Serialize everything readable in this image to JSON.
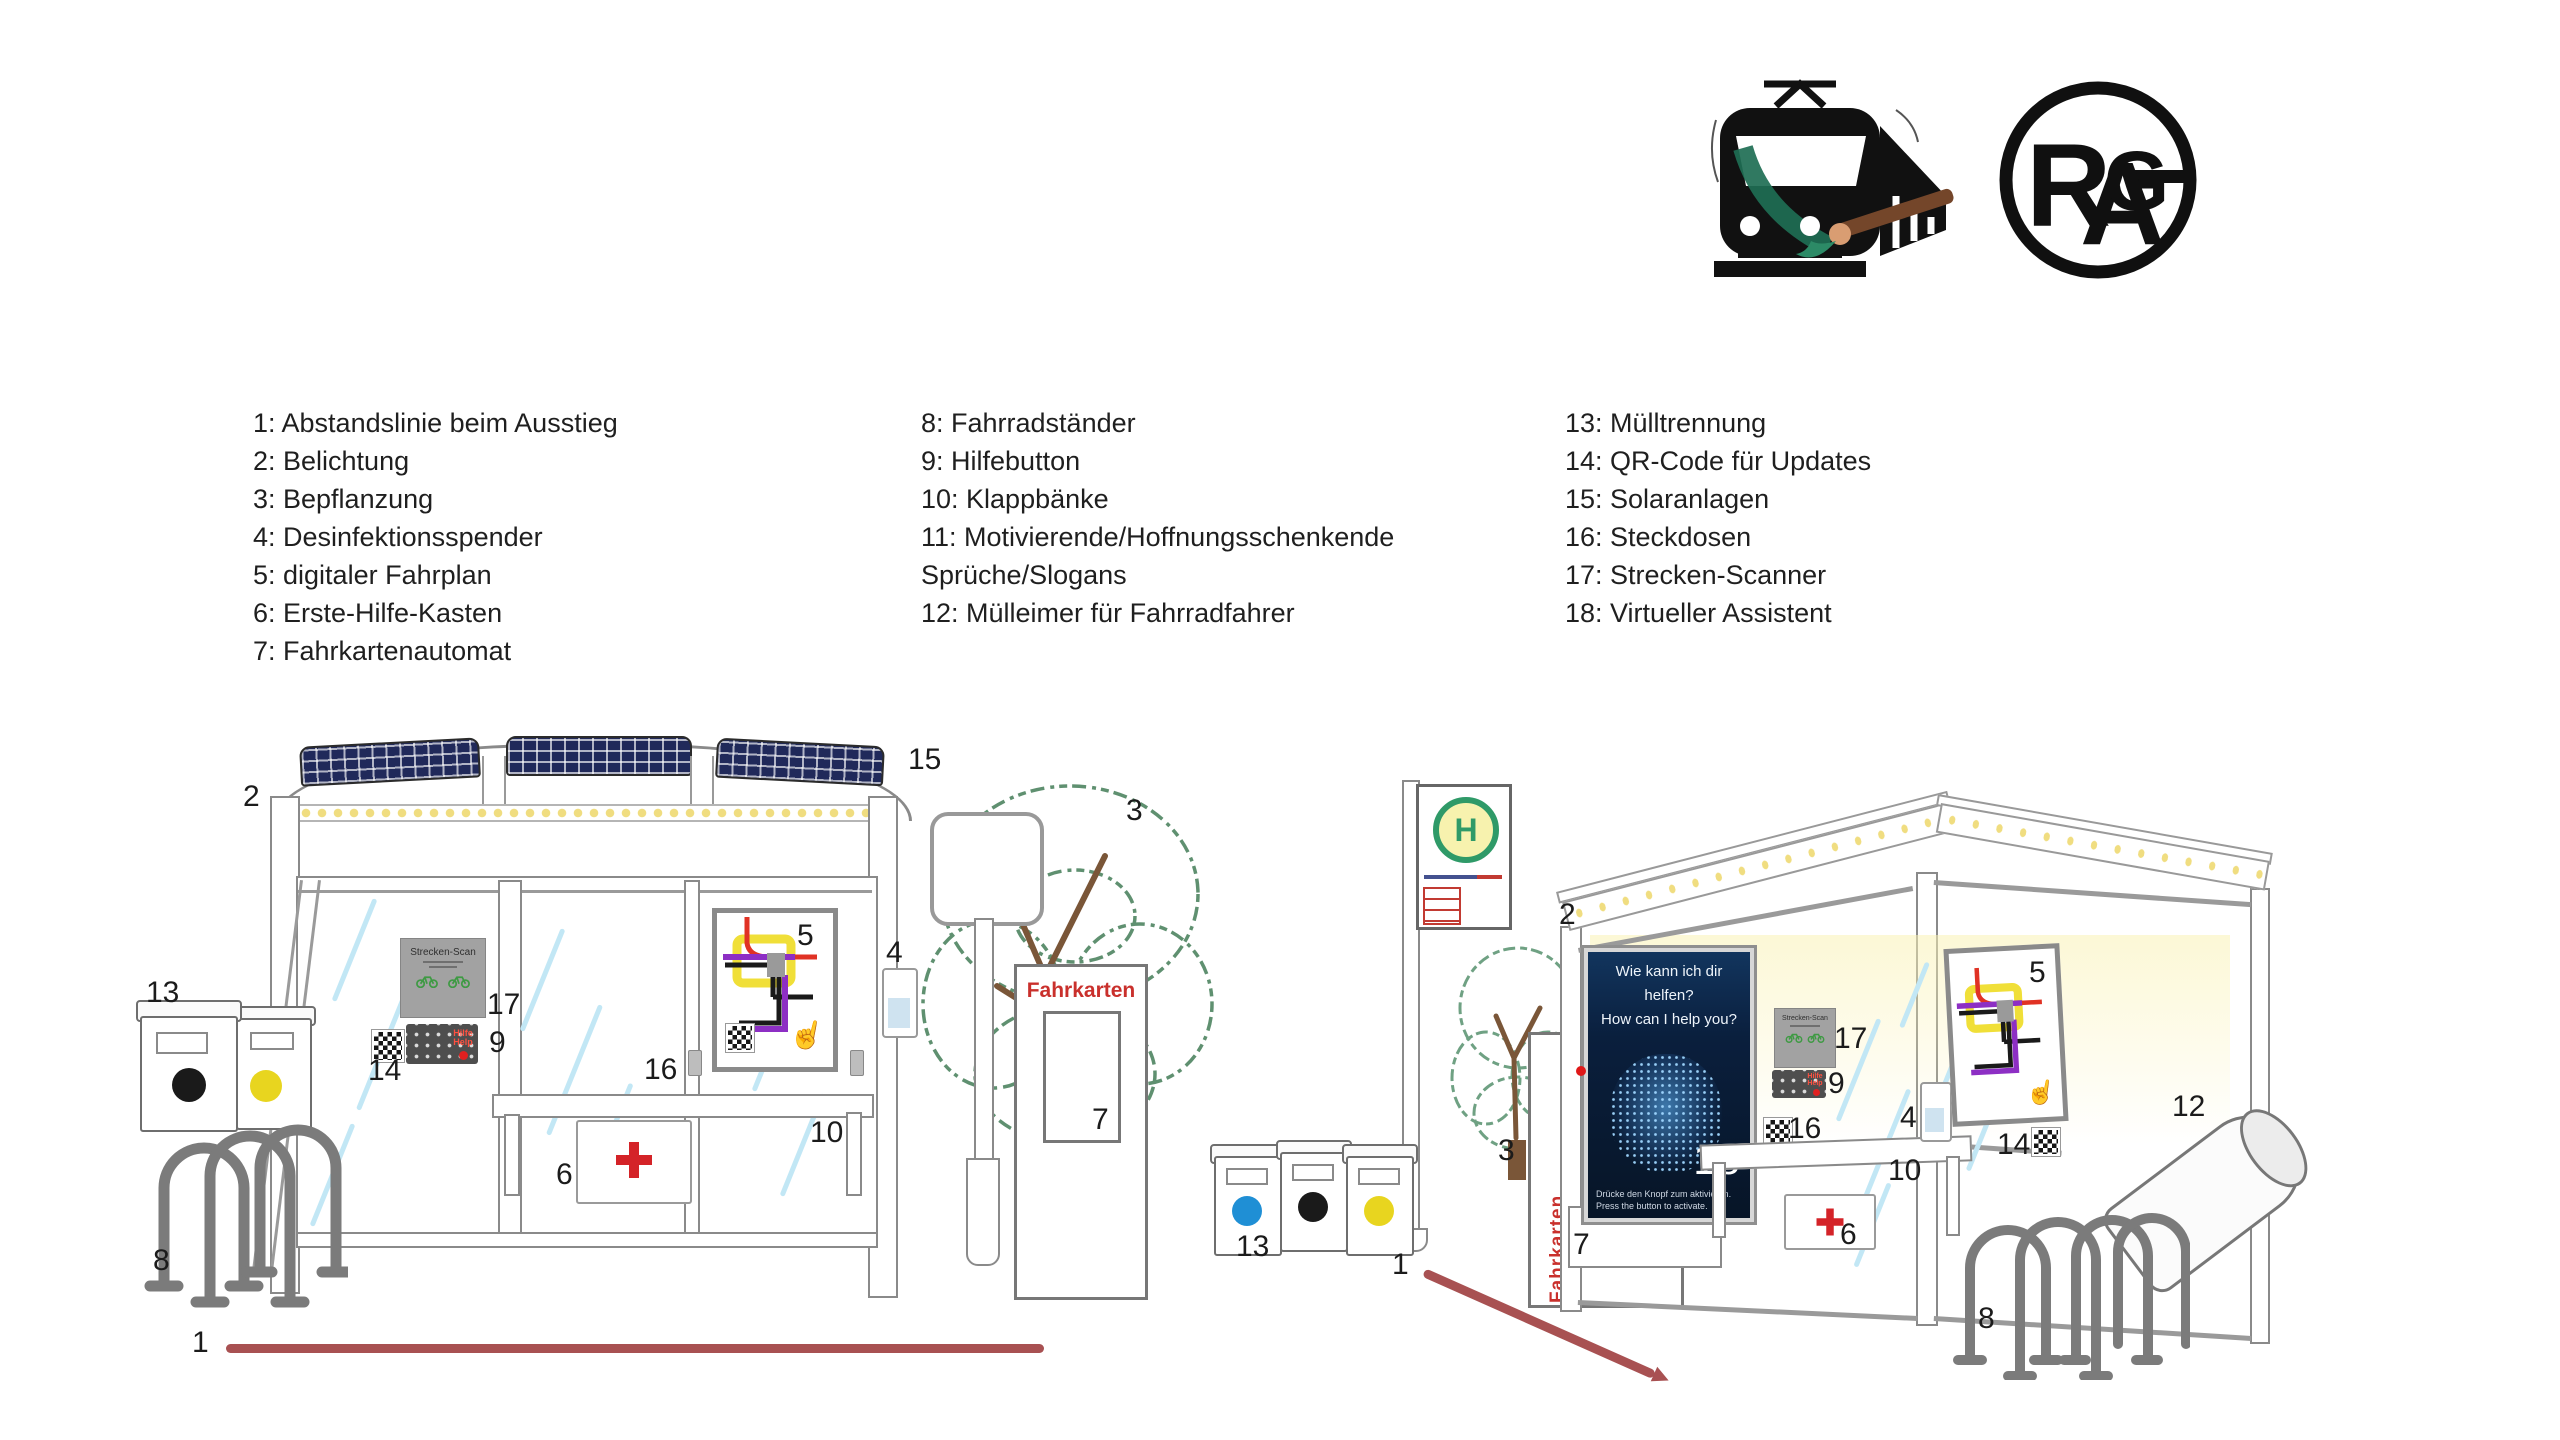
{
  "legend": {
    "columns": [
      {
        "items": [
          "1: Abstandslinie beim Ausstieg",
          "2: Belichtung",
          "3: Bepflanzung",
          "4: Desinfektionsspender",
          "5: digitaler Fahrplan",
          "6: Erste-Hilfe-Kasten",
          "7: Fahrkartenautomat"
        ]
      },
      {
        "items": [
          "8: Fahrradständer",
          "9: Hilfebutton",
          "10: Klappbänke",
          "11: Motivierende/Hoffnungsschenkende Sprüche/Slogans",
          "12: Mülleimer für Fahrradfahrer"
        ]
      },
      {
        "items": [
          "13: Mülltrennung",
          "14: QR-Code für Updates",
          "15: Solaranlagen",
          "16: Steckdosen",
          "17: Strecken-Scanner",
          "18: Virtueller Assistent"
        ]
      }
    ]
  },
  "logos": {
    "rag": {
      "r": "R",
      "a": "A",
      "g": "G"
    }
  },
  "scene_left": {
    "ticket_machine_title": "Fahrkarten",
    "scanner_title": "Strecken-Scan",
    "keypad_help_line1": "Hilfe",
    "keypad_help_line2": "Help",
    "callouts": [
      {
        "n": "2",
        "x": 243,
        "y": 782
      },
      {
        "n": "15",
        "x": 908,
        "y": 745
      },
      {
        "n": "3",
        "x": 1126,
        "y": 796
      },
      {
        "n": "4",
        "x": 886,
        "y": 938
      },
      {
        "n": "13",
        "x": 146,
        "y": 978
      },
      {
        "n": "17",
        "x": 487,
        "y": 990
      },
      {
        "n": "9",
        "x": 489,
        "y": 1028
      },
      {
        "n": "14",
        "x": 368,
        "y": 1056
      },
      {
        "n": "16",
        "x": 644,
        "y": 1055
      },
      {
        "n": "5",
        "x": 797,
        "y": 921
      },
      {
        "n": "10",
        "x": 810,
        "y": 1118
      },
      {
        "n": "6",
        "x": 556,
        "y": 1160
      },
      {
        "n": "8",
        "x": 153,
        "y": 1246
      },
      {
        "n": "7",
        "x": 1092,
        "y": 1105
      },
      {
        "n": "1",
        "x": 192,
        "y": 1328
      }
    ]
  },
  "scene_right": {
    "stop_sign_letter": "H",
    "ticket_machine_title": "Fahrkarten",
    "scanner_title": "Strecken-Scan",
    "keypad_help_line1": "Hilfe",
    "keypad_help_line2": "Help",
    "poster": {
      "line1": "Wie kann ich dir",
      "line2": "helfen?",
      "line3": "How can I help you?",
      "number": "18",
      "footer_line1": "Drücke den Knopf zum aktivieren.",
      "footer_line2": "Press the button to activate."
    },
    "callouts": [
      {
        "n": "2",
        "x": 1559,
        "y": 900
      },
      {
        "n": "3",
        "x": 1498,
        "y": 1136
      },
      {
        "n": "13",
        "x": 1236,
        "y": 1232
      },
      {
        "n": "1",
        "x": 1392,
        "y": 1250
      },
      {
        "n": "7",
        "x": 1573,
        "y": 1230
      },
      {
        "n": "17",
        "x": 1834,
        "y": 1024
      },
      {
        "n": "9",
        "x": 1828,
        "y": 1069
      },
      {
        "n": "16",
        "x": 1788,
        "y": 1114
      },
      {
        "n": "4",
        "x": 1900,
        "y": 1103
      },
      {
        "n": "10",
        "x": 1888,
        "y": 1156
      },
      {
        "n": "6",
        "x": 1840,
        "y": 1220
      },
      {
        "n": "14",
        "x": 1997,
        "y": 1130
      },
      {
        "n": "5",
        "x": 2029,
        "y": 958
      },
      {
        "n": "12",
        "x": 2172,
        "y": 1092
      },
      {
        "n": "8",
        "x": 1978,
        "y": 1304
      }
    ]
  },
  "colors": {
    "distance_line_red": "#a85152",
    "ticket_red": "#c9302c",
    "solar_panel_navy": "#20295a",
    "led_yellow": "#f0dd80",
    "stop_sign_green": "#2f9a68",
    "poster_navy": "#0a1f3d",
    "tree_green": "#5f9070",
    "first_aid_red": "#d42328",
    "glass_blue": "#c2e7f5",
    "frame_gray": "#8a8a8a"
  }
}
